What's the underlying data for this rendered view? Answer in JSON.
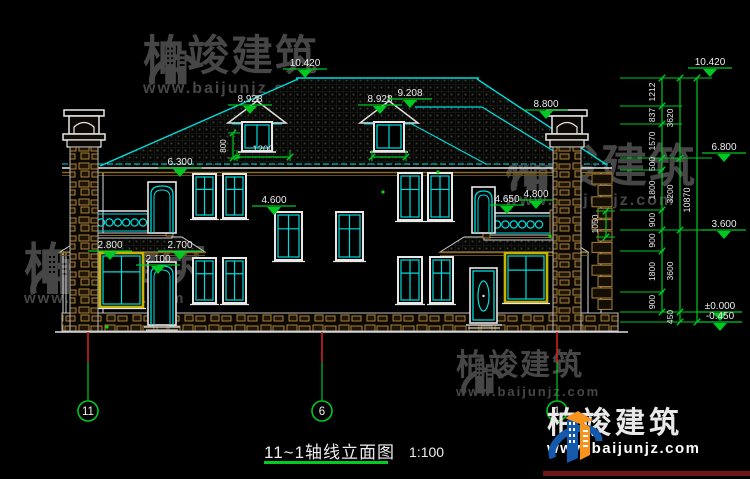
{
  "drawing": {
    "title": "11~1轴线立面图",
    "scale": "1:100"
  },
  "watermark": {
    "title": "柏竣建筑",
    "url": "www.baijunjz.com"
  },
  "logo": {
    "title": "柏竣建筑",
    "url": "www.baijunjz.com"
  },
  "axes": [
    {
      "label": "11",
      "x": 88
    },
    {
      "label": "6",
      "x": 322
    },
    {
      "label": "1",
      "x": 557
    }
  ],
  "elevation_markers": [
    {
      "v": "10.420",
      "x": 283,
      "y": 69
    },
    {
      "v": "8.928",
      "x": 228,
      "y": 105
    },
    {
      "v": "8.928",
      "x": 358,
      "y": 105
    },
    {
      "v": "9.208",
      "x": 388,
      "y": 99
    },
    {
      "v": "8.800",
      "x": 524,
      "y": 110
    },
    {
      "v": "6.300",
      "x": 158,
      "y": 168
    },
    {
      "v": "4.600",
      "x": 252,
      "y": 206
    },
    {
      "v": "4.650",
      "x": 490,
      "y": 205,
      "w": 34
    },
    {
      "v": "4.800",
      "x": 519,
      "y": 200,
      "w": 34
    },
    {
      "v": "2.800",
      "x": 88,
      "y": 251
    },
    {
      "v": "2.700",
      "x": 158,
      "y": 251
    },
    {
      "v": "2.100",
      "x": 136,
      "y": 265
    }
  ],
  "elevation_markers_right": [
    {
      "v": "10.420",
      "x": 688,
      "y": 68
    },
    {
      "v": "6.800",
      "x": 702,
      "y": 153
    },
    {
      "v": "3.600",
      "x": 702,
      "y": 230
    },
    {
      "v": "±0.000",
      "x": 698,
      "y": 312
    },
    {
      "v": "-0.450",
      "x": 698,
      "y": 322
    }
  ],
  "dim_chain": {
    "ticks1": [
      78,
      106,
      124,
      158,
      170,
      210,
      230,
      251,
      292,
      312
    ],
    "col1": [
      "1212",
      "837",
      "1570",
      "500",
      "1800",
      "900",
      "900",
      "1800",
      "900"
    ],
    "ticks2": [
      78,
      158,
      230,
      312,
      322
    ],
    "col2": [
      "3620",
      "3200",
      "3600",
      "450"
    ],
    "total": "10870",
    "ext_levels": {
      "78": 712,
      "106": 682,
      "124": 682,
      "158": 712,
      "170": 664,
      "210": 664,
      "230": 712,
      "251": 664,
      "292": 664,
      "312": 712,
      "322": 712
    }
  },
  "small_dims": {
    "dormer_width": "1200",
    "dormer_height": "800",
    "balcony_height": "1050"
  },
  "colors": {
    "line_cyan": "#00dcdc",
    "line_white": "#e8e8e8",
    "dim_green": "#00c820",
    "axis_red": "#cc2020",
    "stone_tan": "#a8823c",
    "frame_yellow": "#c8b400",
    "watermark_gray": "#4d4d4d",
    "logo_blue": "#1559ac",
    "logo_orange": "#f7941d",
    "logo_bar_maroon": "#6e1616"
  }
}
